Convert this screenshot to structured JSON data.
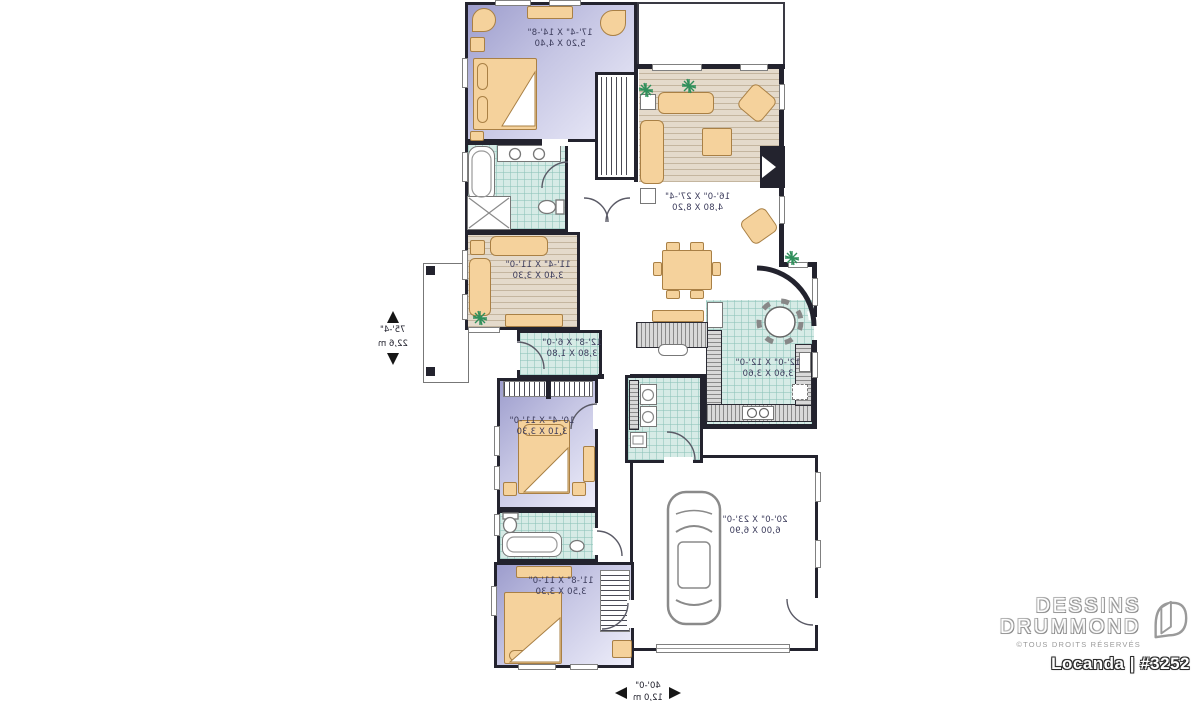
{
  "brand": {
    "line1": "DESSINS",
    "line2": "DRUMMOND",
    "copyright": "©TOUS DROITS RÉSERVÉS",
    "plan_label": "Locanda | #3252"
  },
  "overall_dimensions": {
    "depth_ft": "75'-4\"",
    "depth_m": "22,6 m",
    "width_ft": "40'-0\"",
    "width_m": "12,0 m"
  },
  "rooms": [
    {
      "id": "master-bedroom",
      "size_ft": "17'-4\" X 14'-8\"",
      "size_m": "5,20 X 4,40"
    },
    {
      "id": "living-room",
      "size_ft": "16'-0\" X 27'-4\"",
      "size_m": "4,80 X 8,20"
    },
    {
      "id": "den",
      "size_ft": "11'-4\" X 11'-0\"",
      "size_m": "3,40 X 3,30"
    },
    {
      "id": "hall",
      "size_ft": "12'-8\" X 6'-0\"",
      "size_m": "3,80 X 1,80"
    },
    {
      "id": "kitchen",
      "size_ft": "12'-0\" X 12'-0\"",
      "size_m": "3,60 X 3,60"
    },
    {
      "id": "bedroom-2",
      "size_ft": "10'-4\" X 11'-0\"",
      "size_m": "3,10 X 3,30"
    },
    {
      "id": "bedroom-3",
      "size_ft": "11'-8\" X 11'-0\"",
      "size_m": "3,50 X 3,30"
    },
    {
      "id": "garage",
      "size_ft": "20'-0\" X 23'-0\"",
      "size_m": "6,00 X 6,90"
    }
  ],
  "colors": {
    "wall": "#23232e",
    "bedroom_floor": "#b9b9dd",
    "tile_floor": "#d6ebe6",
    "wood_floor": "#e4dacb",
    "furniture": "#f5d29c",
    "plant": "#2f8f5b",
    "logo_gray": "#9a9a9a"
  },
  "notes": {
    "text_orientation": "mirrored"
  }
}
